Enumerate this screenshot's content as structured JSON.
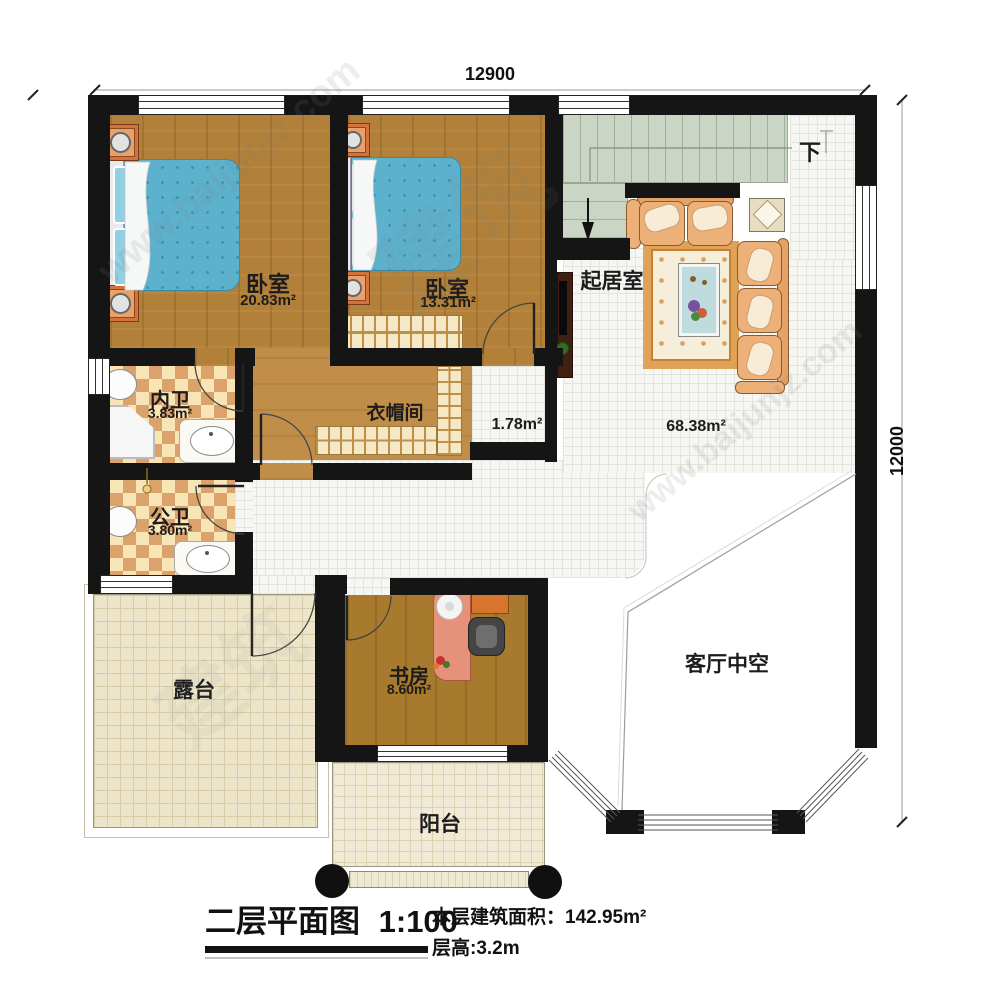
{
  "dimensions": {
    "top": "12900",
    "right": "12000"
  },
  "rooms": {
    "bedroom1": {
      "name": "卧室",
      "area": "20.83m²"
    },
    "bedroom2": {
      "name": "卧室",
      "area": "13.31m²"
    },
    "living_room": {
      "name": "起居室",
      "area": "68.38m²"
    },
    "ensuite_bath": {
      "name": "内卫",
      "area": "3.83m²"
    },
    "public_bath": {
      "name": "公卫",
      "area": "3.80m²"
    },
    "cloakroom": {
      "name": "衣帽间"
    },
    "hallway": {
      "area": "1.78m²"
    },
    "study": {
      "name": "书房",
      "area": "8.60m²"
    },
    "terrace": {
      "name": "露台"
    },
    "balcony": {
      "name": "阳台"
    },
    "living_void": {
      "name": "客厅中空"
    }
  },
  "stairs": {
    "down_label": "下"
  },
  "title_block": {
    "title": "二层平面图",
    "scale": "1:100",
    "area_label": "本层建筑面积：",
    "area_value": "142.95m²",
    "height_label": "层高:3.2m"
  },
  "watermark": {
    "site": "www.baijunjz.com",
    "brand": "建筑"
  },
  "colors": {
    "wall": "#151515",
    "bedroom_wood": "#b28038",
    "study_wood": "#a87a2e",
    "bed_cover": "#5cb1cd",
    "stairs": "#cbd5c5",
    "bath_tile_dark": "#dca26b",
    "bath_tile_light": "#f8e5b6",
    "indoor_tile": "#f6f6f3",
    "outdoor_tile": "#ece5c9",
    "sofa": "#ecb078",
    "nightstand": "#d4713c"
  }
}
